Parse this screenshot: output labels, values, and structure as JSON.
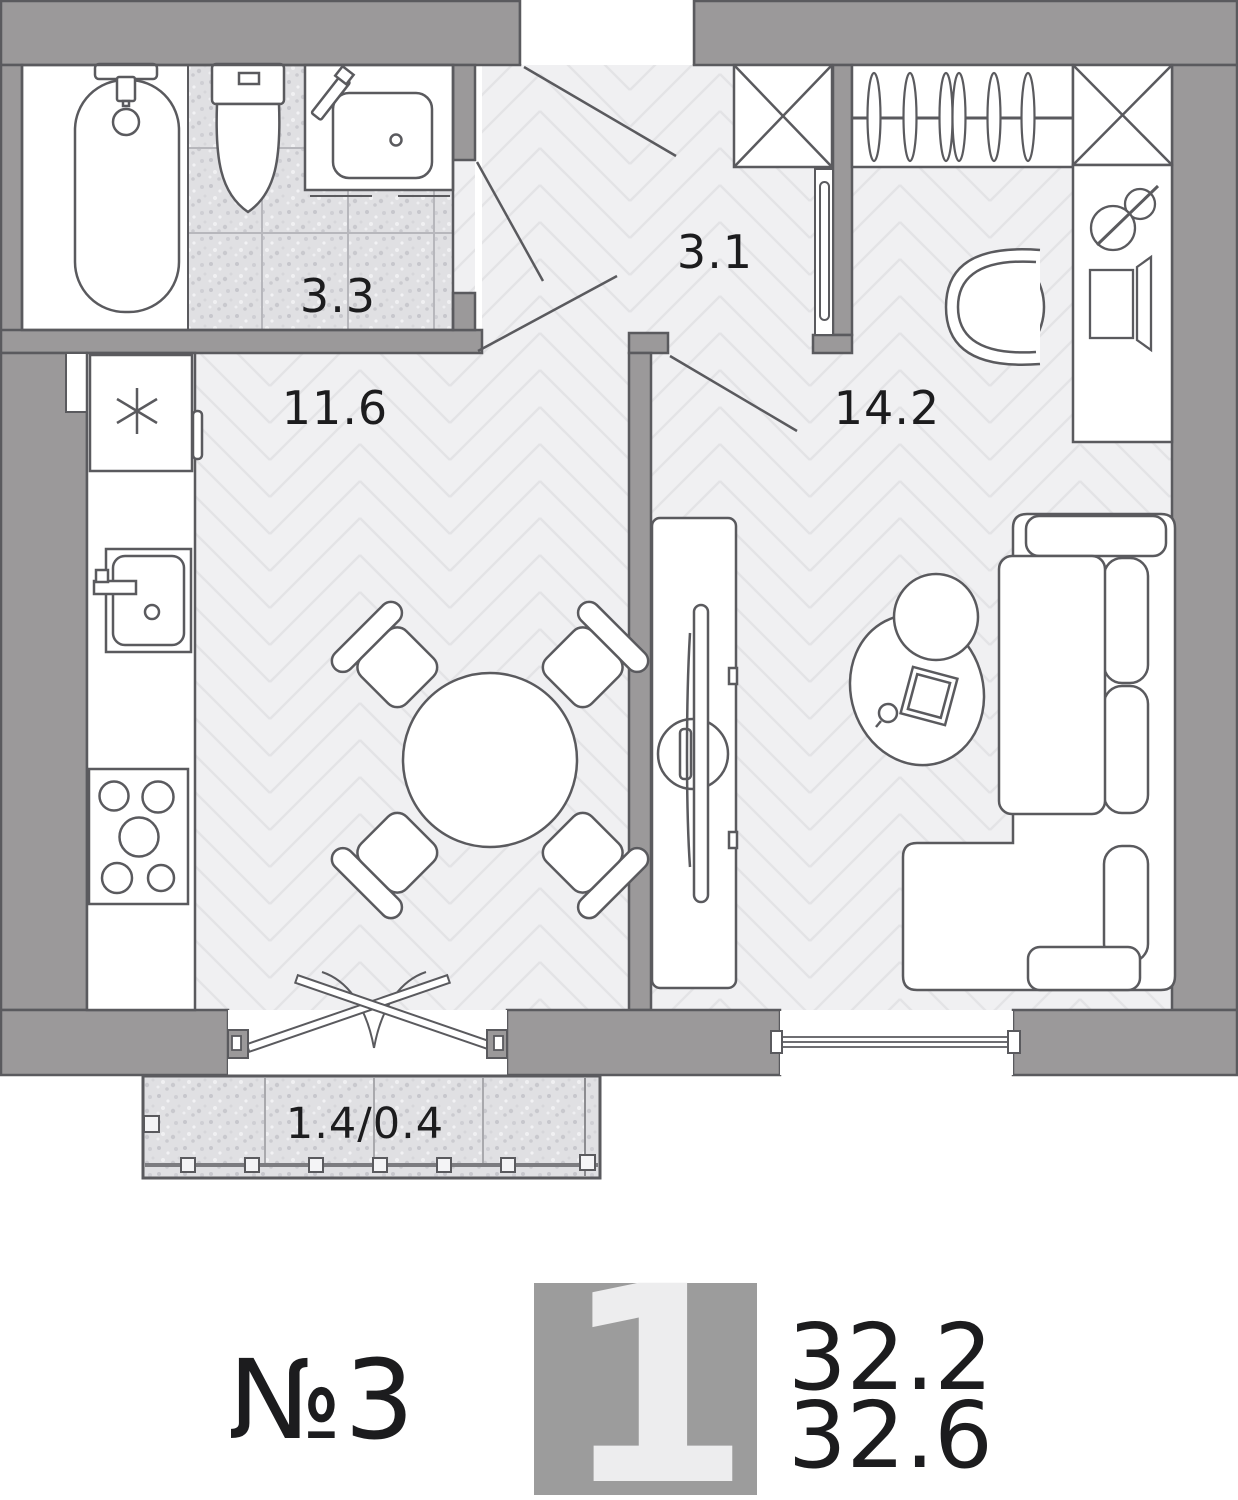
{
  "plan": {
    "rooms": [
      {
        "id": "bathroom",
        "area_label": "3.3"
      },
      {
        "id": "hallway",
        "area_label": "3.1"
      },
      {
        "id": "kitchen",
        "area_label": "11.6"
      },
      {
        "id": "living-room",
        "area_label": "14.2"
      },
      {
        "id": "balcony",
        "area_label": "1.4/0.4"
      }
    ],
    "fixtures": [
      "bathtub",
      "toilet",
      "washbasin",
      "fridge",
      "kitchen-sink",
      "stove",
      "dining-table",
      "four-chairs",
      "tv-console",
      "sofa",
      "coffee-table",
      "wardrobe-hangers",
      "shaft-x2",
      "desk",
      "desk-chair",
      "desk-lamp",
      "monitor",
      "balcony-railing",
      "french-doors",
      "window"
    ]
  },
  "legend": {
    "apartment_number": "№3",
    "room_count": "1",
    "living_area": "32.2",
    "total_area": "32.6"
  },
  "colors": {
    "wall": "#9b999a",
    "outline": "#5a5a5e",
    "floor": "#f0f0f2",
    "floor_line": "#e3e3e6",
    "tile": "#e0e0e3",
    "legend_block": "#9c9c9c",
    "legend_numeral": "#ededee",
    "text": "#1c1c1e"
  }
}
